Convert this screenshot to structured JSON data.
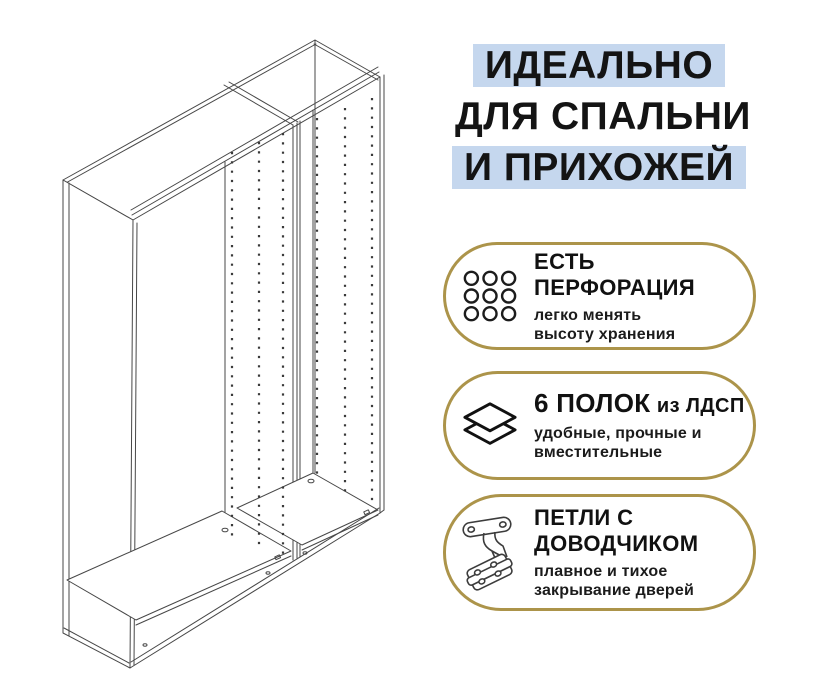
{
  "colors": {
    "background": "#ffffff",
    "highlight_blue": "#c5d7ee",
    "accent_gold": "#ac944a",
    "text": "#141414",
    "line_art": "#474747"
  },
  "headline": {
    "line1": "ИДЕАЛЬНО",
    "line2": "ДЛЯ СПАЛЬНИ",
    "line3": "И ПРИХОЖЕЙ"
  },
  "illustration": {
    "icon": "wardrobe-frames-line-art"
  },
  "features": [
    {
      "icon": "perforation-grid-icon",
      "title_lines": [
        "ЕСТЬ",
        "ПЕРФОРАЦИЯ"
      ],
      "subtitle_lines": [
        "легко менять",
        "высоту хранения"
      ]
    },
    {
      "icon": "shelves-layers-icon",
      "title": "6 ПОЛОК",
      "title_suffix": "из ЛДСП",
      "subtitle_lines": [
        "удобные, прочные и",
        "вместительные"
      ]
    },
    {
      "icon": "hinge-icon",
      "title_lines": [
        "ПЕТЛИ С",
        "ДОВОДЧИКОМ"
      ],
      "subtitle_lines": [
        "плавное и тихое",
        "закрывание дверей"
      ]
    }
  ]
}
